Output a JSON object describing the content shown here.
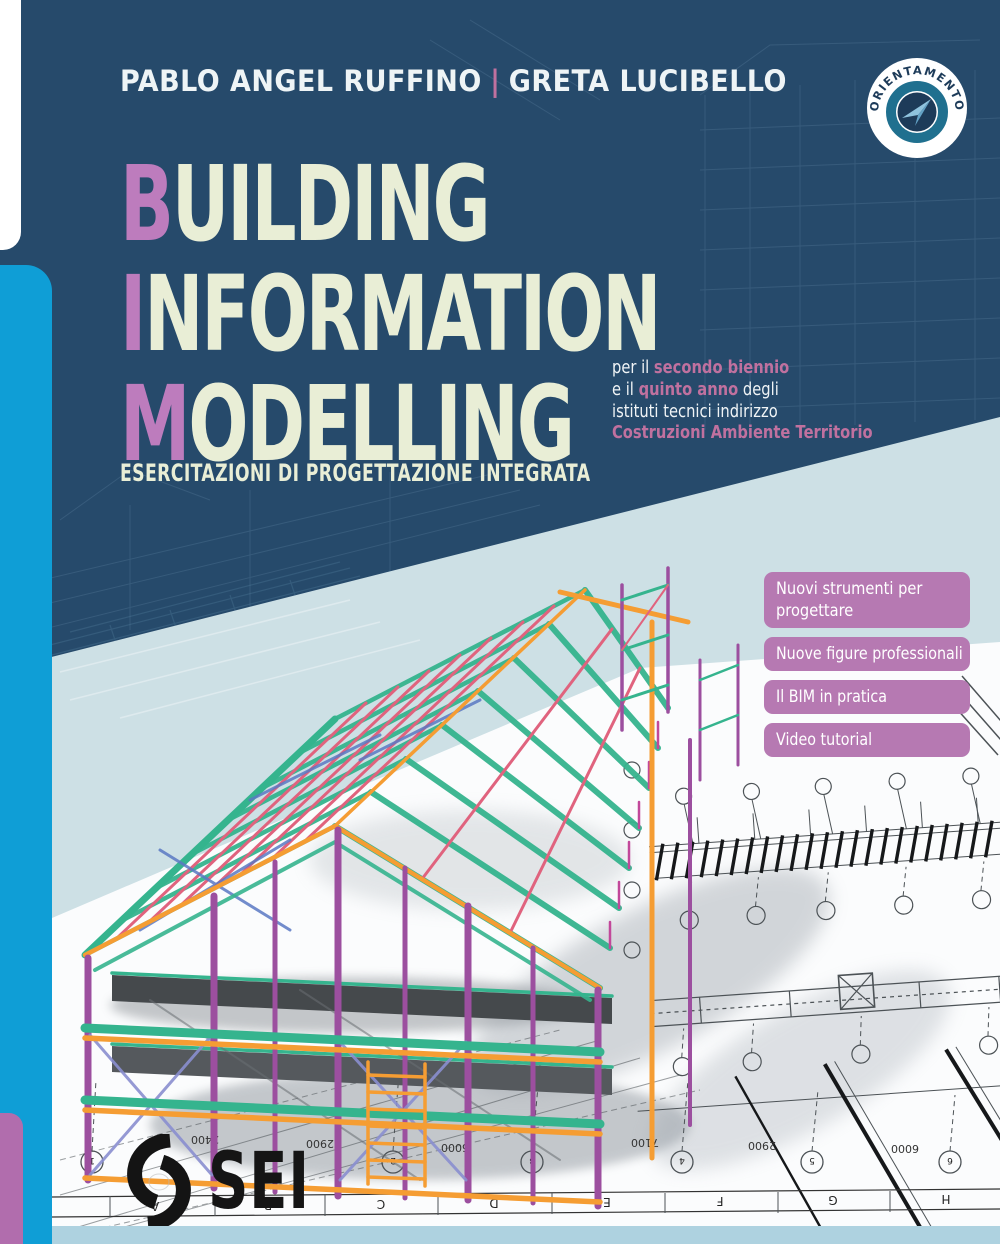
{
  "authors": {
    "first": "PABLO ANGEL RUFFINO",
    "separator": "|",
    "second": "GRETA LUCIBELLO"
  },
  "badge": {
    "label": "ORIENTAMENTO"
  },
  "title": {
    "lines": [
      {
        "initial": "B",
        "rest": "UILDING"
      },
      {
        "initial": "I",
        "rest": "NFORMATION"
      },
      {
        "initial": "M",
        "rest": "ODELLING"
      }
    ]
  },
  "subtitle": "ESERCITAZIONI DI PROGETTAZIONE INTEGRATA",
  "edition": {
    "line1_pre": "per il ",
    "line1_hl": "secondo biennio",
    "line2_pre": "e il ",
    "line2_hl": "quinto anno",
    "line2_post": " degli",
    "line3": "istituti tecnici indirizzo",
    "line4": "Costruzioni Ambiente Territorio"
  },
  "features": {
    "items": [
      {
        "label": "Nuovi strumenti per progettare"
      },
      {
        "label": "Nuove figure professionali"
      },
      {
        "label": "Il BIM in pratica"
      },
      {
        "label": "Video tutorial"
      }
    ]
  },
  "publisher": {
    "name": "SEI"
  },
  "drawing": {
    "dimension_labels": [
      "2400",
      "2900",
      "6000",
      "7100",
      "2900",
      "6000"
    ],
    "grid_letters": [
      "A",
      "B",
      "C",
      "D",
      "E",
      "F",
      "G",
      "H"
    ],
    "axis_numbers": [
      "1",
      "2",
      "3",
      "4",
      "5",
      "6"
    ]
  },
  "colors": {
    "navy": "#264a6b",
    "light_bg": "#cde0e5",
    "band": "#aed2e0",
    "cyan": "#0f9ed6",
    "pink_tab": "#b16dad",
    "pale": "#e9eed6",
    "mauve": "#bd7cbd",
    "rose": "#c0719f",
    "pill": "#b679b2",
    "badge_teal": "#20708f",
    "badge_navy": "#1d3b59",
    "plane_light": "#8fc3de",
    "plane_dark": "#63a2c6",
    "m_teal": "#35b48e",
    "m_pink": "#e0637e",
    "m_orange": "#f59d33",
    "m_purple": "#9c4f9f"
  }
}
